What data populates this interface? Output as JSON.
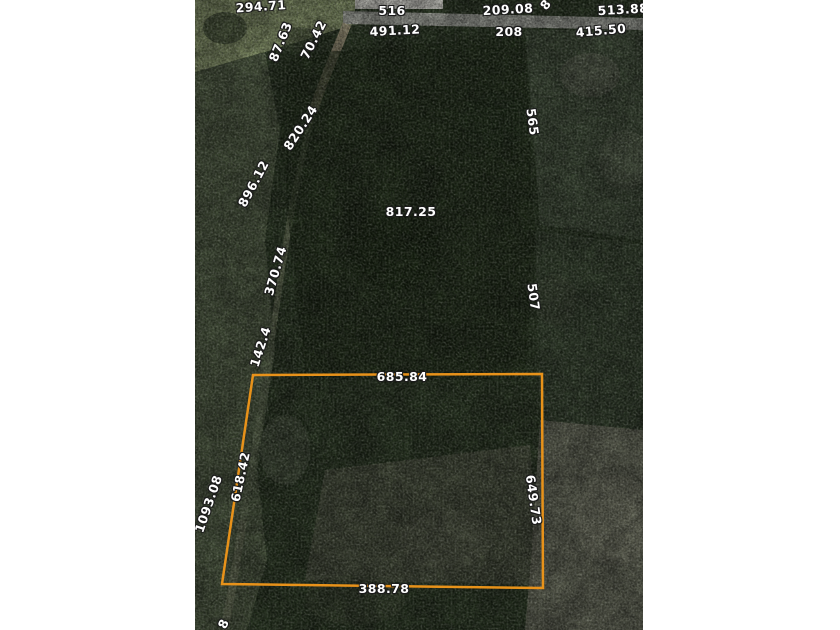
{
  "map": {
    "type": "aerial parcel survey",
    "colors": {
      "parcel_outline": "#e8921a",
      "label_text": "#ffffff",
      "canvas_background": "#ffffff"
    },
    "parcel_sides": {
      "top": "685.84",
      "right": "649.73",
      "bottom": "388.78",
      "left": "618.42"
    },
    "labels": [
      {
        "text": "294.71"
      },
      {
        "text": "87.63"
      },
      {
        "text": "70.42"
      },
      {
        "text": "516"
      },
      {
        "text": "491.12"
      },
      {
        "text": "209.08"
      },
      {
        "text": "208"
      },
      {
        "text": "513.88"
      },
      {
        "text": "415.50"
      },
      {
        "text": "8"
      },
      {
        "text": "820.24"
      },
      {
        "text": "896.12"
      },
      {
        "text": "370.74"
      },
      {
        "text": "817.25"
      },
      {
        "text": "565"
      },
      {
        "text": "507"
      },
      {
        "text": "142.4"
      },
      {
        "text": "685.84"
      },
      {
        "text": "649.73"
      },
      {
        "text": "618.42"
      },
      {
        "text": "1093.08"
      },
      {
        "text": "388.78"
      },
      {
        "text": "8"
      }
    ]
  }
}
